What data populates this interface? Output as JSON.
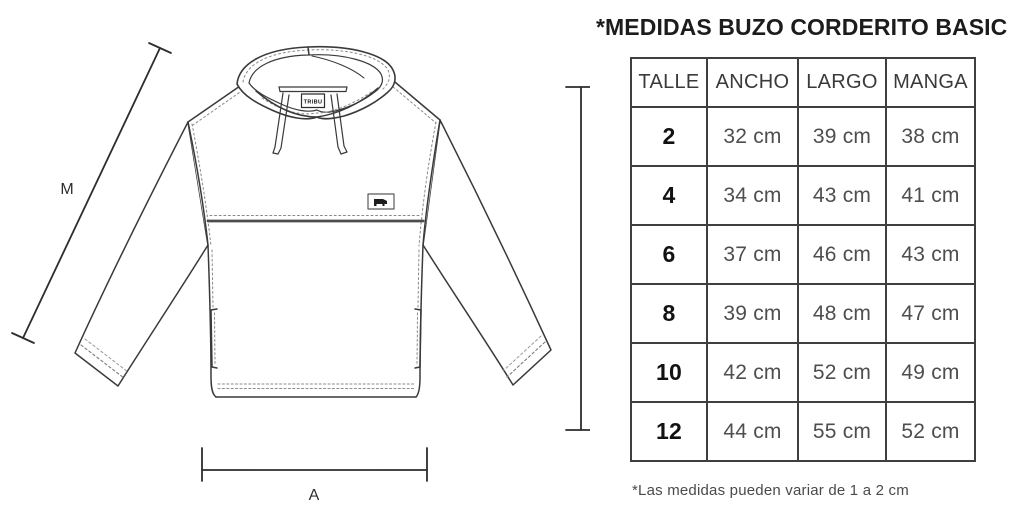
{
  "title": "*MEDIDAS BUZO CORDERITO BASIC",
  "footnote": "*Las medidas pueden variar de 1 a 2 cm",
  "table": {
    "headers": [
      "TALLE",
      "ANCHO",
      "LARGO",
      "MANGA"
    ],
    "rows": [
      [
        "2",
        "32 cm",
        "39 cm",
        "38 cm"
      ],
      [
        "4",
        "34 cm",
        "43 cm",
        "41 cm"
      ],
      [
        "6",
        "37 cm",
        "46 cm",
        "43 cm"
      ],
      [
        "8",
        "39 cm",
        "48 cm",
        "47 cm"
      ],
      [
        "10",
        "42 cm",
        "52 cm",
        "49 cm"
      ],
      [
        "12",
        "44 cm",
        "55 cm",
        "52 cm"
      ]
    ]
  },
  "diagram": {
    "measure_labels": {
      "sleeve": "M",
      "length": "L",
      "width": "A"
    },
    "neck_tag": "TRIBU"
  },
  "colors": {
    "line": "#3a3a3a",
    "stitch": "#8a8a8a",
    "heading": "#1c1c1c",
    "cell_text": "#4e4e4e"
  }
}
